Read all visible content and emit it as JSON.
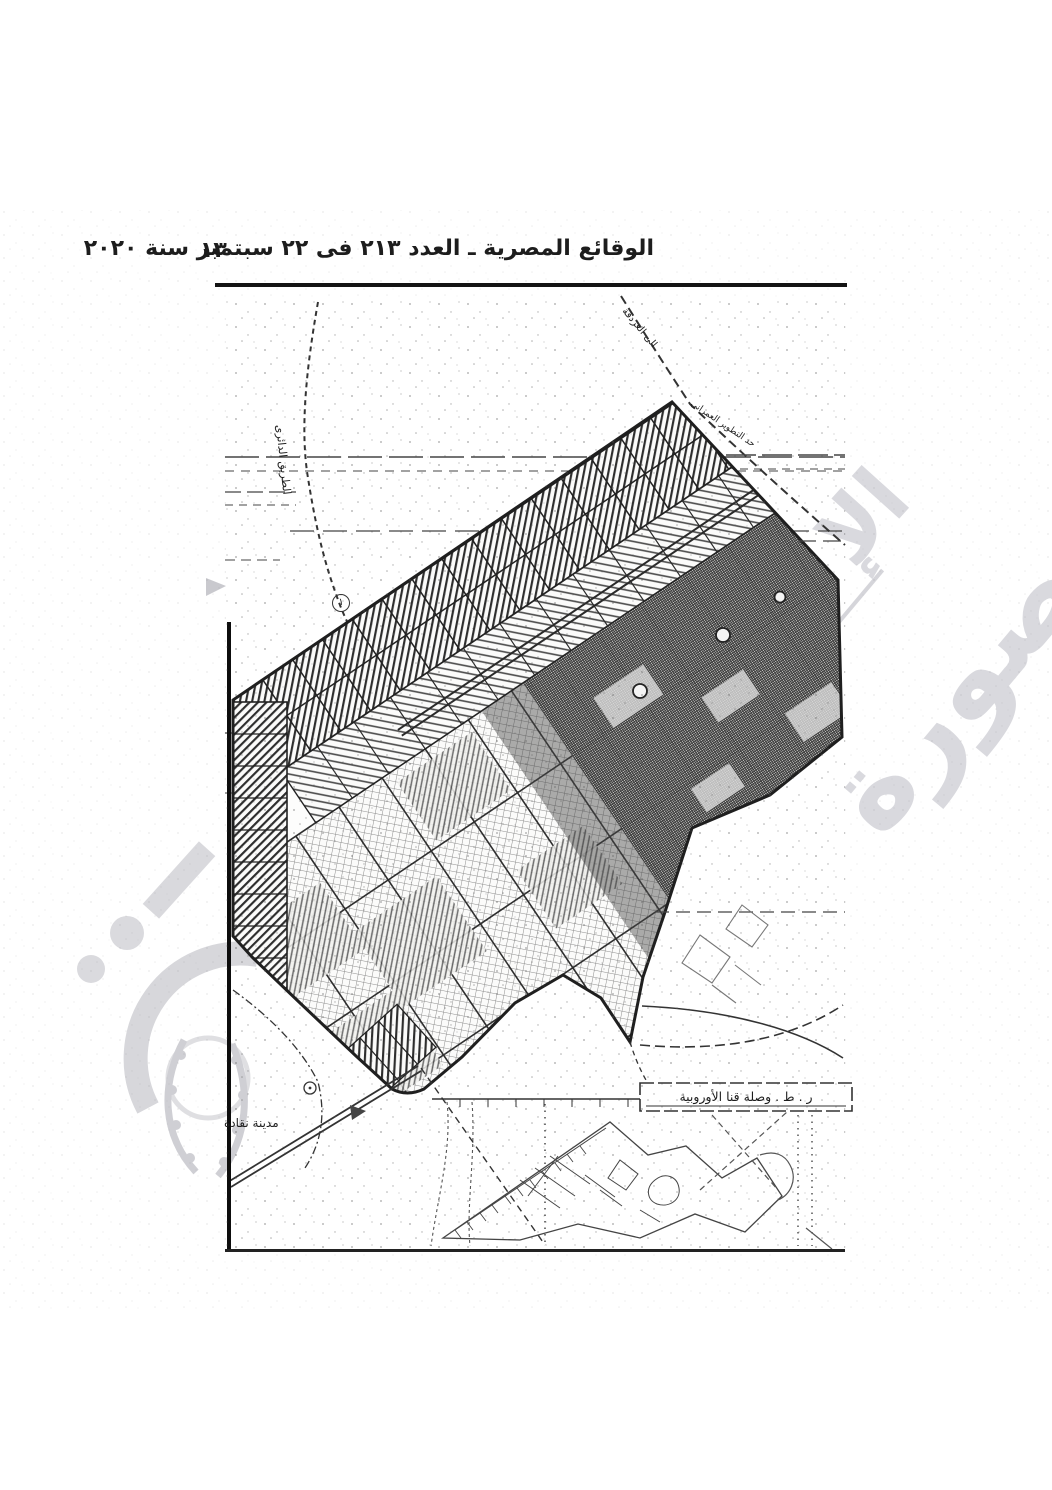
{
  "colors": {
    "ink": "#161616",
    "map_line": "#2b2b2b",
    "watermark_gray": "#d9d9de"
  },
  "header": {
    "title": "الوقائع المصرية ـ العدد ٢١٣ فى ٢٢ سبتمبر سنة ٢٠٢٠",
    "page_number": "١٣"
  },
  "map": {
    "labels": {
      "ring_road": "الطريق الدائرى",
      "to_hurghada": "الى الغردقة",
      "development_edge": "حد التطوير العمرانى",
      "city_southwest": "مدينة نقادة",
      "circled_marker": "١",
      "inset_box": "ر . ط . وصلة قنا الأوروبية"
    }
  },
  "watermarks": {
    "stamp_fragment": "الإ",
    "stamp_word": "صورة"
  }
}
